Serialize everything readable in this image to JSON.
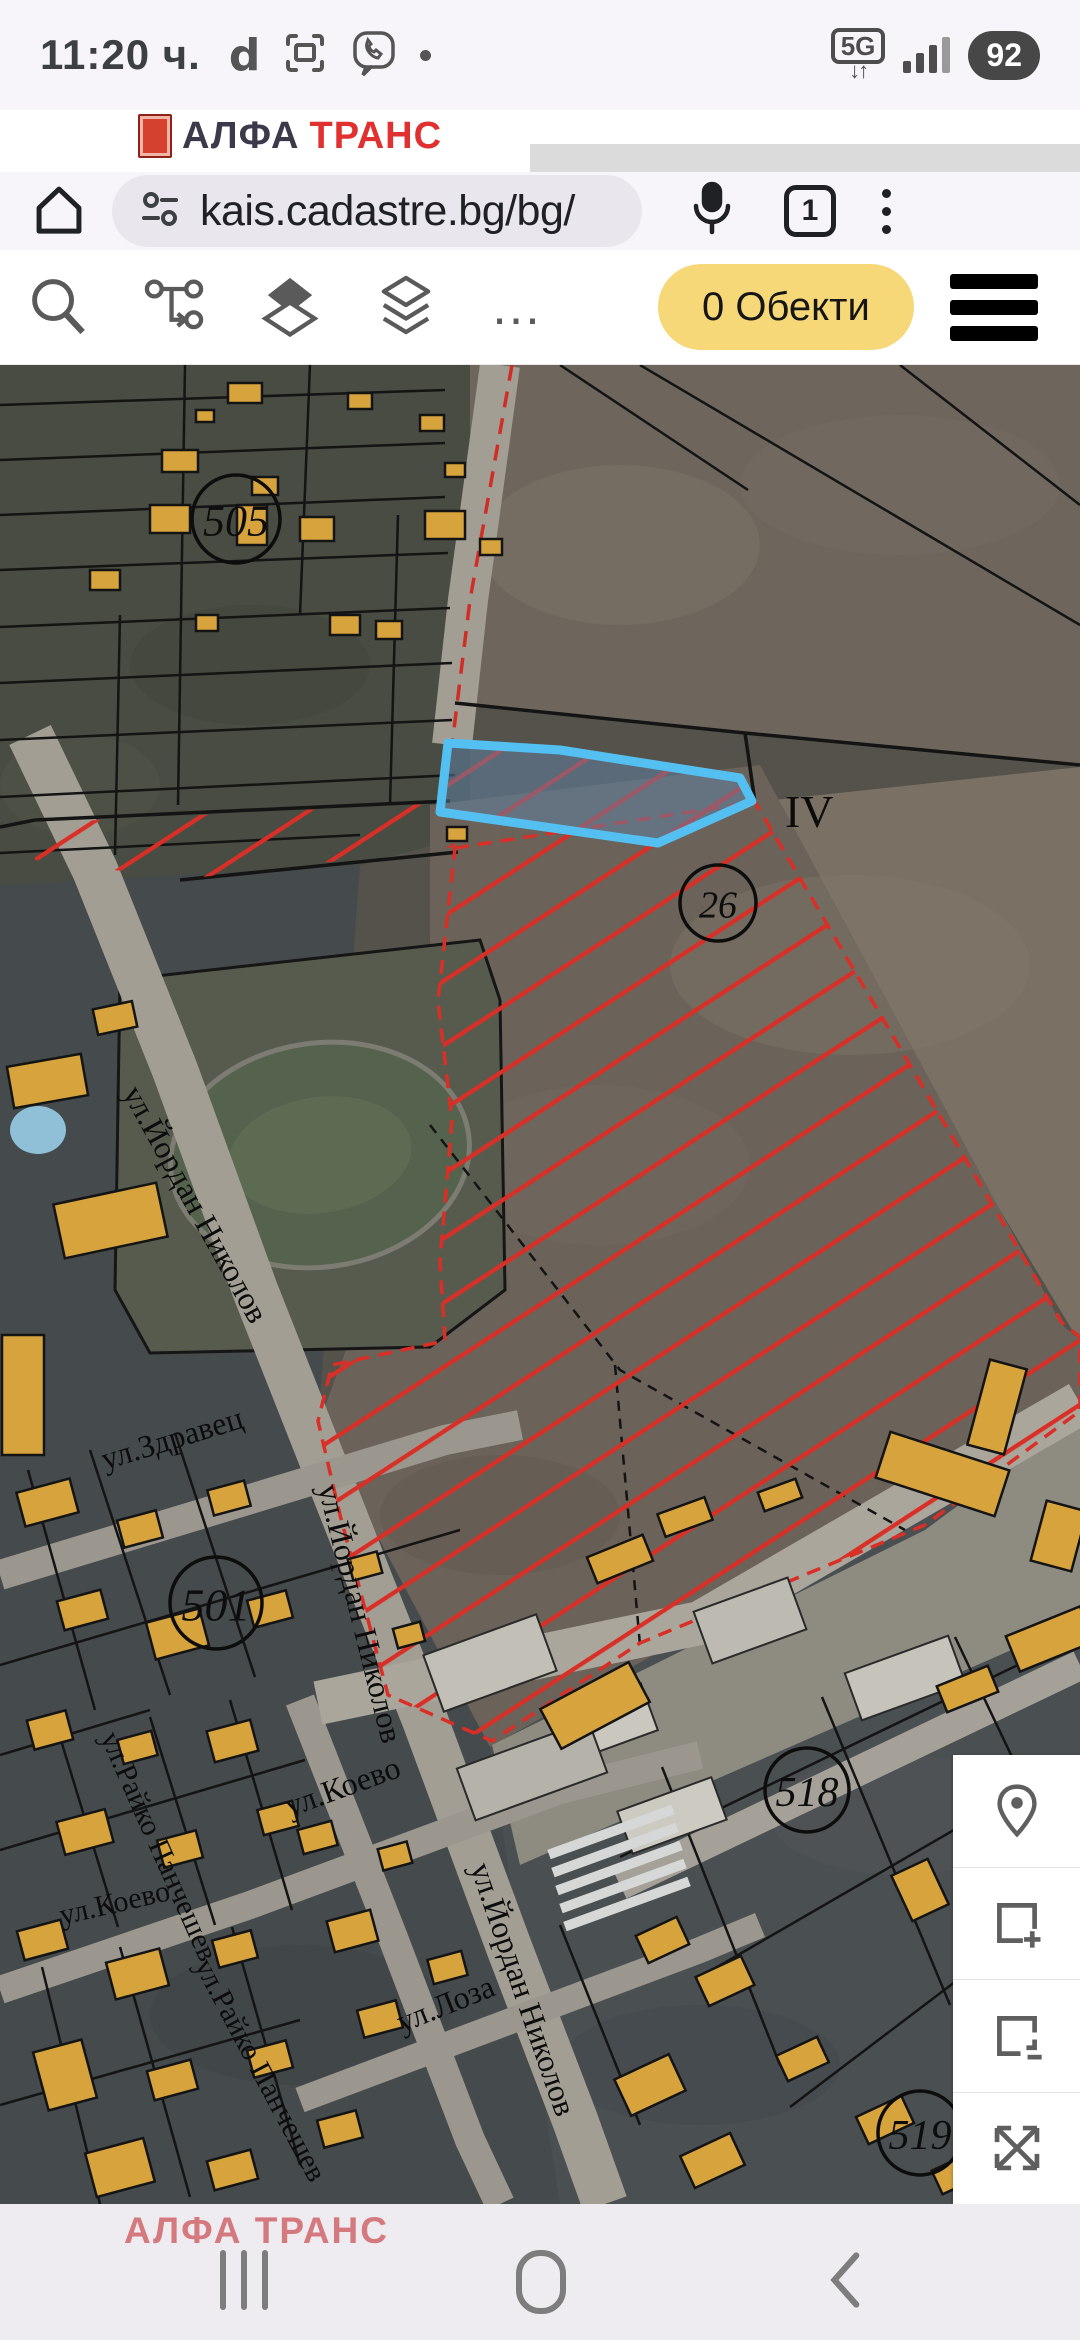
{
  "status": {
    "time": "11:20 ч.",
    "app_letter": "d",
    "network": "5G",
    "battery": "92"
  },
  "banner": {
    "brand1": "АЛФА",
    "brand2": "ТРАНС"
  },
  "browser": {
    "url": "kais.cadastre.bg/bg/",
    "tab_count": "1"
  },
  "app_toolbar": {
    "objects_button": "0 Обекти"
  },
  "bottom": {
    "watermark": "АЛФА ТРАНС"
  },
  "colors": {
    "accent_yellow": "#f6d878",
    "building_yellow": "#d7a33c",
    "hatch_red": "#d92f26",
    "selection_blue": "#54c0f2",
    "road_grey": "#a29e94"
  },
  "map": {
    "viewbox": "0 0 1080 1839",
    "layers": [
      {
        "k": "poly",
        "n": "map-base",
        "p": "0,0 1080,0 1080,1839 0,1839",
        "f": "#54524a"
      },
      {
        "k": "poly",
        "n": "region-topleft",
        "p": "0,0 470,0 470,470 360,500 0,520",
        "f": "#484c42"
      },
      {
        "k": "poly",
        "n": "region-topright-field",
        "p": "470,0 1080,0 1080,402 745,368 470,340",
        "f": "#6e665c"
      },
      {
        "k": "poly",
        "n": "region-iv-field",
        "p": "755,437 1080,402 1080,978",
        "f": "#7a7164"
      },
      {
        "k": "poly",
        "n": "region-center-field",
        "p": "430,440 760,400 1062,960 1080,975 1080,1050 490,1382 318,1060 430,760",
        "f": "#6b6259"
      },
      {
        "k": "poly",
        "n": "region-lowerleft",
        "p": "0,520 360,500 318,1060 490,1382 560,1839 0,1839",
        "f": "#454a4c"
      },
      {
        "k": "poly",
        "n": "region-lowerright",
        "p": "490,1382 1080,1050 1080,1839 560,1839",
        "f": "#4a4f52"
      },
      {
        "k": "poly",
        "n": "region-industrial",
        "p": "492,1380 925,1165 1080,1050 1080,1255 520,1500",
        "f": "#8e8b81"
      },
      {
        "k": "ell",
        "cx": 620,
        "cy": 180,
        "rx": 140,
        "ry": 80,
        "f": "#7b7268",
        "o": 0.5
      },
      {
        "k": "ell",
        "cx": 900,
        "cy": 120,
        "rx": 160,
        "ry": 70,
        "f": "#766d63",
        "o": 0.4
      },
      {
        "k": "ell",
        "cx": 850,
        "cy": 600,
        "rx": 180,
        "ry": 90,
        "f": "#857b6e",
        "o": 0.35
      },
      {
        "k": "ell",
        "cx": 600,
        "cy": 800,
        "rx": 150,
        "ry": 80,
        "f": "#756c61",
        "o": 0.35
      },
      {
        "k": "ell",
        "cx": 500,
        "cy": 1150,
        "rx": 120,
        "ry": 60,
        "f": "#5e574e",
        "o": 0.4
      },
      {
        "k": "ell",
        "cx": 250,
        "cy": 300,
        "rx": 120,
        "ry": 60,
        "f": "#3f4339",
        "o": 0.5
      },
      {
        "k": "ell",
        "cx": 80,
        "cy": 420,
        "rx": 80,
        "ry": 50,
        "f": "#525648",
        "o": 0.5
      },
      {
        "k": "ell",
        "cx": 900,
        "cy": 1450,
        "rx": 130,
        "ry": 60,
        "f": "#55595c",
        "o": 0.35
      },
      {
        "k": "ell",
        "cx": 300,
        "cy": 1650,
        "rx": 150,
        "ry": 70,
        "f": "#3c4145",
        "o": 0.4
      },
      {
        "k": "ell",
        "cx": 700,
        "cy": 1700,
        "rx": 140,
        "ry": 60,
        "f": "#41464a",
        "o": 0.4
      },
      {
        "k": "poly",
        "n": "stadium-parcel",
        "p": "120,615 480,575 500,635 505,925 430,982 150,988 115,925",
        "f": "#575b4e",
        "s": "#161616",
        "w": 3
      },
      {
        "k": "ell",
        "n": "stadium-track",
        "cx": 320,
        "cy": 790,
        "rx": 150,
        "ry": 112,
        "f": "#55624d",
        "s": "#7d7c72",
        "w": 5,
        "rot": -8
      },
      {
        "k": "ell",
        "n": "stadium-infield",
        "cx": 320,
        "cy": 790,
        "rx": 92,
        "ry": 58,
        "f": "#5e6b53",
        "rot": -8
      },
      {
        "k": "ell",
        "n": "pool",
        "cx": 38,
        "cy": 765,
        "rx": 28,
        "ry": 24,
        "f": "#8fc0d8"
      },
      {
        "k": "line",
        "n": "road-yordan-nikolov",
        "p": "30,370 95,505 175,705 255,925 330,1115 425,1355 510,1585 575,1755 605,1839",
        "s": "#a29e94",
        "w": 46
      },
      {
        "k": "line",
        "n": "road-top",
        "p": "500,0 468,235 452,380",
        "s": "#a29e94",
        "w": 40
      },
      {
        "k": "line",
        "n": "road-zdravets",
        "p": "0,1210 445,1075 520,1060",
        "s": "#9b978e",
        "w": 30
      },
      {
        "k": "line",
        "n": "road-koevo",
        "p": "0,1625 250,1540 560,1425 700,1390",
        "s": "#9b978e",
        "w": 28
      },
      {
        "k": "line",
        "n": "road-rayko",
        "p": "300,1335 390,1565 470,1775 500,1839",
        "s": "#9b978e",
        "w": 30
      },
      {
        "k": "line",
        "n": "road-loza",
        "p": "300,1735 700,1585 760,1560",
        "s": "#9b978e",
        "w": 26
      },
      {
        "k": "line",
        "n": "road-industrial",
        "p": "318,1338 700,1258 1080,1038",
        "s": "#aaa69c",
        "w": 44
      },
      {
        "k": "line",
        "n": "road-lowerright",
        "p": "620,1520 1080,1300",
        "s": "#a5a198",
        "w": 30
      },
      {
        "k": "line",
        "n": "cadastre-red-boundary",
        "p": "512,0 470,235 452,380",
        "s": "#cf2d26",
        "w": 3.5,
        "d": "16 11"
      },
      {
        "k": "lines",
        "n": "parcel-line",
        "s": "#141414",
        "w": 2.5,
        "items": [
          "0,40 445,25",
          "0,95 445,78",
          "0,150 445,132",
          "0,205 448,188",
          "0,262 450,243",
          "0,318 452,298",
          "0,375 452,355",
          "0,432 455,410",
          "0,488 360,470",
          "185,0 178,440",
          "310,0 300,250",
          "398,150 390,440",
          "120,250 115,490",
          "640,0 1080,260",
          "560,0 748,125",
          "900,0 1080,140",
          "0,1300 460,1165",
          "0,1485 305,1395",
          "0,1740 300,1655",
          "0,1390 150,1345",
          "90,1085 170,1330",
          "28,1105 95,1345",
          "175,1068 255,1312",
          "150,1352 215,1560",
          "60,1372 118,1562",
          "230,1335 292,1545",
          "120,1582 190,1832",
          "42,1602 100,1839",
          "232,1562 300,1800",
          "620,1492 1080,1270",
          "700,1612 1080,1392",
          "790,1742 1080,1522",
          "662,1402 780,1700",
          "822,1332 950,1640",
          "955,1272 1080,1535",
          "560,1560 640,1760"
        ]
      },
      {
        "k": "lines",
        "n": "parcel-line-strong",
        "s": "#141414",
        "w": 3.5,
        "items": [
          "455,338 745,368 1080,400",
          "745,368 755,437",
          "35,455 450,436",
          "180,515 458,487",
          "0,462 35,455"
        ]
      },
      {
        "k": "lines",
        "n": "parcel-line-dashed",
        "s": "#141414",
        "w": 2.5,
        "d": "10 8",
        "items": [
          "430,760 620,1005 905,1165",
          "615,1000 640,1280"
        ]
      },
      {
        "k": "hatch",
        "n": "restriction-hatch-strip",
        "p": "35,458 448,438 455,482 185,514 35,495"
      },
      {
        "k": "hatch",
        "n": "restriction-hatch-area",
        "p": "455,483 755,437 1062,958 1080,972 1080,1046 925,1160 640,1278 492,1376 388,1330 340,1150 318,1056 332,1000 445,976 440,896 452,756 438,636",
        "s": "#d92f26",
        "w": 3.5,
        "d": "14 9"
      },
      {
        "k": "blds",
        "n": "industrial-building",
        "f0": "#c2bfb7",
        "s": "#2a2a2a",
        "w": 2,
        "items": [
          [
            430,
            1268,
            120,
            60,
            -20
          ],
          [
            562,
            1332,
            90,
            50,
            -20,
            "#cac7bf"
          ],
          [
            700,
            1228,
            100,
            55,
            -20,
            "#bdbab2"
          ],
          [
            850,
            1288,
            110,
            50,
            -20,
            "#c6c3bb"
          ],
          [
            462,
            1378,
            140,
            55,
            -20,
            "#b5b2aa"
          ],
          [
            622,
            1428,
            100,
            45,
            -20,
            "#cdcac2"
          ]
        ]
      },
      {
        "k": "blds",
        "n": "greenhouse",
        "f0": "#d5d8d6",
        "s": "none",
        "w": 0,
        "items": [
          [
            545,
            1462,
            132,
            10,
            -20
          ],
          [
            549,
            1480,
            132,
            10,
            -20
          ],
          [
            553,
            1498,
            132,
            10,
            -20
          ],
          [
            557,
            1516,
            132,
            10,
            -20
          ],
          [
            561,
            1534,
            132,
            10,
            -20
          ]
        ]
      },
      {
        "k": "blds",
        "n": "map-building",
        "f0": "#d7a33c",
        "s": "#141414",
        "w": 2.5,
        "items": [
          [
            228,
            18,
            34,
            20,
            0
          ],
          [
            348,
            28,
            24,
            16,
            0
          ],
          [
            196,
            45,
            18,
            12,
            0
          ],
          [
            162,
            85,
            36,
            22,
            0
          ],
          [
            252,
            112,
            26,
            18,
            0
          ],
          [
            420,
            50,
            24,
            16,
            0
          ],
          [
            445,
            98,
            20,
            14,
            0
          ],
          [
            150,
            140,
            40,
            28,
            0
          ],
          [
            237,
            140,
            30,
            40,
            0
          ],
          [
            300,
            152,
            34,
            24,
            0
          ],
          [
            425,
            146,
            40,
            28,
            0
          ],
          [
            480,
            174,
            22,
            16,
            0
          ],
          [
            90,
            205,
            30,
            20,
            0
          ],
          [
            330,
            250,
            30,
            20,
            0
          ],
          [
            376,
            256,
            26,
            18,
            0
          ],
          [
            196,
            250,
            22,
            16,
            0
          ],
          [
            447,
            462,
            20,
            14,
            0
          ],
          [
            10,
            695,
            75,
            42,
            -10
          ],
          [
            58,
            828,
            105,
            55,
            -12
          ],
          [
            2,
            970,
            42,
            120,
            0
          ],
          [
            95,
            640,
            40,
            26,
            -12
          ],
          [
            20,
            1120,
            55,
            35,
            -15
          ],
          [
            120,
            1150,
            40,
            28,
            -15
          ],
          [
            210,
            1120,
            38,
            26,
            -15
          ],
          [
            60,
            1230,
            45,
            30,
            -15
          ],
          [
            150,
            1250,
            55,
            38,
            -15
          ],
          [
            250,
            1230,
            40,
            28,
            -15
          ],
          [
            30,
            1350,
            40,
            30,
            -15
          ],
          [
            120,
            1370,
            35,
            25,
            -15
          ],
          [
            210,
            1360,
            45,
            32,
            -15
          ],
          [
            60,
            1450,
            50,
            34,
            -15
          ],
          [
            160,
            1470,
            40,
            28,
            -15
          ],
          [
            260,
            1440,
            36,
            26,
            -15
          ],
          [
            20,
            1560,
            45,
            30,
            -15
          ],
          [
            110,
            1590,
            55,
            38,
            -15
          ],
          [
            215,
            1570,
            40,
            28,
            -15
          ],
          [
            40,
            1680,
            50,
            60,
            -15
          ],
          [
            150,
            1700,
            45,
            30,
            -15
          ],
          [
            250,
            1680,
            40,
            28,
            -15
          ],
          [
            90,
            1780,
            60,
            45,
            -15
          ],
          [
            210,
            1790,
            45,
            30,
            -15
          ],
          [
            320,
            1750,
            40,
            28,
            -15
          ],
          [
            330,
            1550,
            45,
            32,
            -15
          ],
          [
            360,
            1640,
            40,
            28,
            -15
          ],
          [
            300,
            1460,
            35,
            25,
            -15
          ],
          [
            380,
            1480,
            30,
            22,
            -15
          ],
          [
            430,
            1590,
            35,
            25,
            -15
          ],
          [
            350,
            1190,
            30,
            22,
            -15
          ],
          [
            395,
            1260,
            28,
            20,
            -15
          ],
          [
            590,
            1180,
            60,
            28,
            -22
          ],
          [
            545,
            1318,
            100,
            45,
            -28
          ],
          [
            660,
            1140,
            50,
            24,
            -20
          ],
          [
            760,
            1120,
            40,
            20,
            -20
          ],
          [
            880,
            1085,
            125,
            48,
            18
          ],
          [
            978,
            998,
            38,
            88,
            15
          ],
          [
            1038,
            1140,
            42,
            62,
            15
          ],
          [
            1010,
            1255,
            80,
            38,
            -22
          ],
          [
            940,
            1310,
            55,
            28,
            -22
          ],
          [
            640,
            1560,
            45,
            30,
            -25
          ],
          [
            700,
            1600,
            50,
            32,
            -25
          ],
          [
            780,
            1680,
            45,
            28,
            -25
          ],
          [
            860,
            1740,
            50,
            30,
            -25
          ],
          [
            935,
            1795,
            45,
            26,
            -25
          ],
          [
            985,
            1620,
            40,
            60,
            -25
          ],
          [
            1040,
            1700,
            40,
            55,
            -25
          ],
          [
            620,
            1700,
            60,
            40,
            -25
          ],
          [
            685,
            1778,
            55,
            35,
            -25
          ],
          [
            1005,
            1450,
            90,
            40,
            -25
          ],
          [
            1048,
            1528,
            60,
            35,
            -25
          ],
          [
            900,
            1500,
            40,
            50,
            -25
          ]
        ]
      },
      {
        "k": "blue",
        "n": "selected-parcel-blue",
        "p": "448,378 560,385 740,413 752,436 658,478 440,447",
        "i": true
      },
      {
        "k": "txt",
        "n": "map-label-iv",
        "t": "IV",
        "x": 785,
        "y": 462,
        "size": 46,
        "rot": 0
      },
      {
        "k": "circ",
        "n": "map-parcel-number",
        "t": "505",
        "x": 236,
        "y": 154,
        "r": 44
      },
      {
        "k": "circ",
        "n": "map-parcel-number",
        "t": "26",
        "x": 718,
        "y": 538,
        "r": 38
      },
      {
        "k": "circ",
        "n": "map-parcel-number",
        "t": "501",
        "x": 216,
        "y": 1238,
        "r": 46
      },
      {
        "k": "circ",
        "n": "map-parcel-number",
        "t": "518",
        "x": 807,
        "y": 1425,
        "r": 42
      },
      {
        "k": "circ",
        "n": "map-parcel-number",
        "t": "519",
        "x": 920,
        "y": 1768,
        "r": 42
      },
      {
        "k": "txt",
        "n": "map-street-label",
        "t": "ул.Йордан Николов",
        "x": 122,
        "y": 728,
        "size": 32,
        "rot": 61
      },
      {
        "k": "txt",
        "n": "map-street-label",
        "t": "ул.Йордан Николов",
        "x": 318,
        "y": 1122,
        "size": 32,
        "rot": 76
      },
      {
        "k": "txt",
        "n": "map-street-label",
        "t": "ул.Йордан Николов",
        "x": 470,
        "y": 1502,
        "size": 32,
        "rot": 71
      },
      {
        "k": "txt",
        "n": "map-street-label",
        "t": "ул.Здравец",
        "x": 105,
        "y": 1105,
        "size": 32,
        "rot": -17
      },
      {
        "k": "txt",
        "n": "map-street-label",
        "t": "ул.Райко Панчешев",
        "x": 100,
        "y": 1372,
        "size": 30,
        "rot": 66
      },
      {
        "k": "txt",
        "n": "map-street-label",
        "t": "ул.Коево",
        "x": 62,
        "y": 1560,
        "size": 30,
        "rot": -13
      },
      {
        "k": "txt",
        "n": "map-street-label",
        "t": "ул.Коево",
        "x": 290,
        "y": 1452,
        "size": 32,
        "rot": -20
      },
      {
        "k": "txt",
        "n": "map-street-label",
        "t": "ул.Райко Панчешев",
        "x": 194,
        "y": 1600,
        "size": 30,
        "rot": 62
      },
      {
        "k": "txt",
        "n": "map-street-label",
        "t": "ул.Лоза",
        "x": 402,
        "y": 1668,
        "size": 32,
        "rot": -22
      }
    ]
  }
}
